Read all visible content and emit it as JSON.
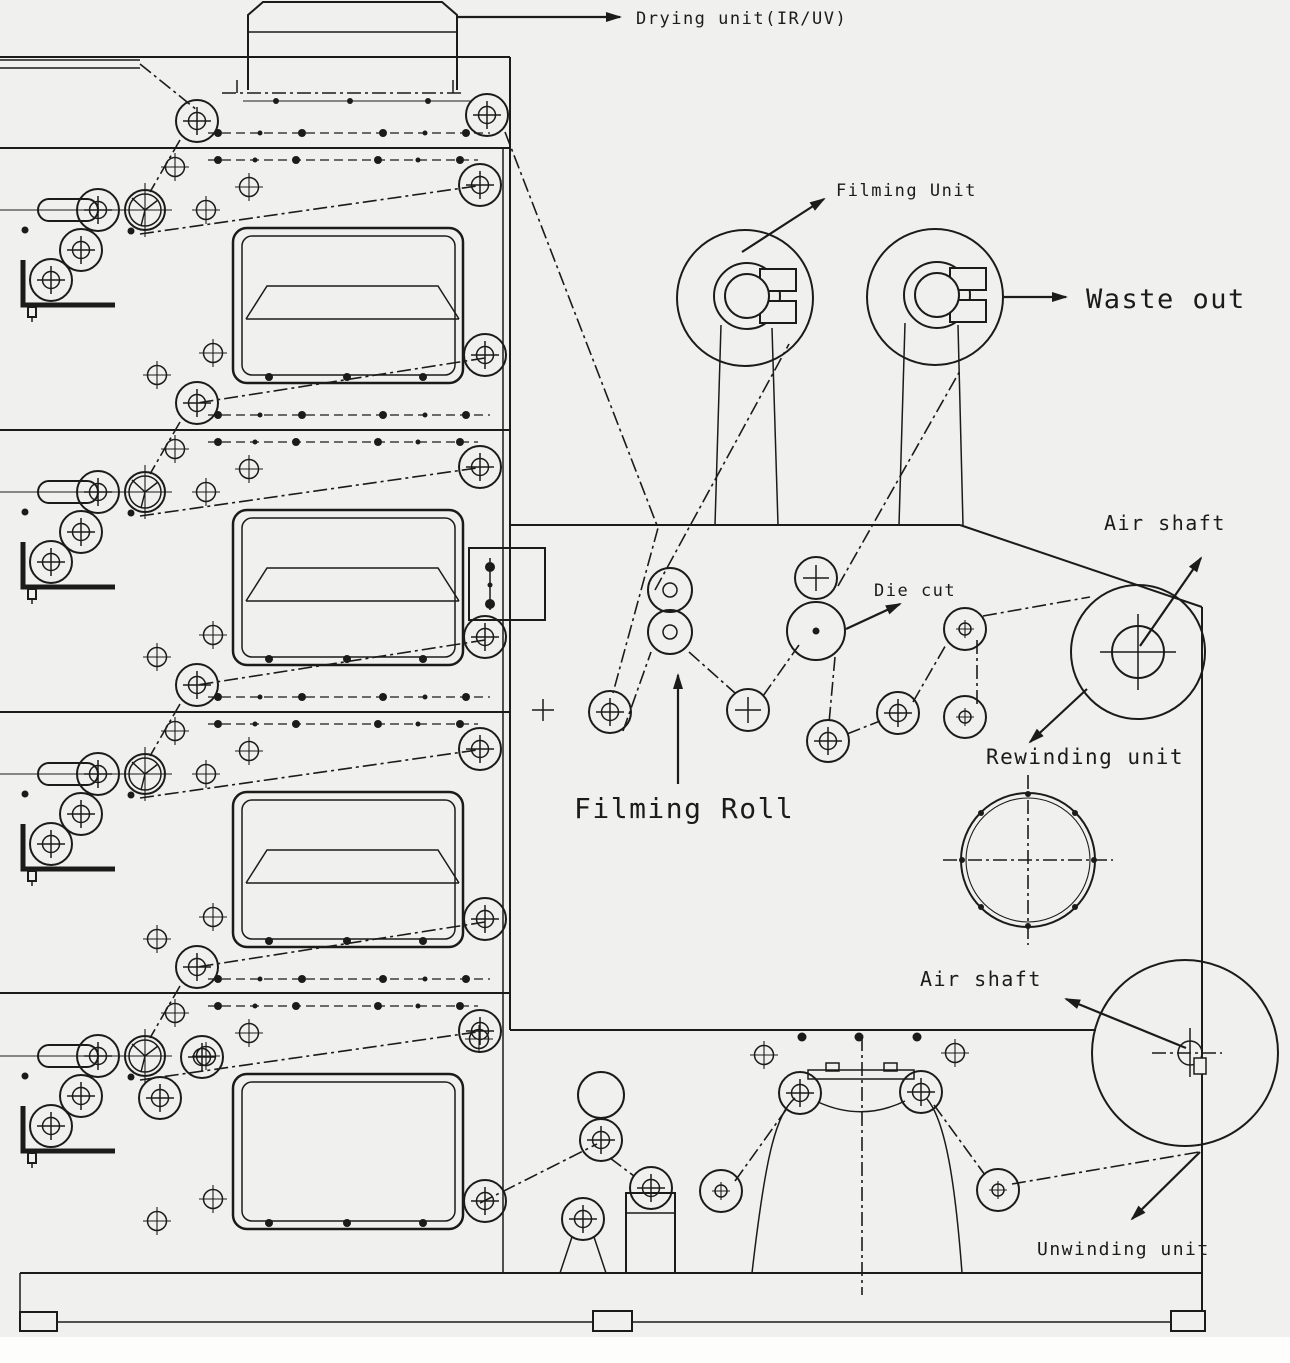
{
  "diagram_title": "Label printing press schematic",
  "labels": {
    "drying_unit": "Drying unit(IR/UV)",
    "filming_unit": "Filming Unit",
    "waste_out": "Waste out",
    "air_shaft_top": "Air shaft",
    "die_cut": "Die cut",
    "rewinding_unit": "Rewinding unit",
    "filming_roll": "Filming Roll",
    "air_shaft_bottom": "Air shaft",
    "unwinding_unit": "Unwinding unit"
  },
  "colors": {
    "line": "#1b1b1b",
    "paper": "#f0f1ee"
  }
}
